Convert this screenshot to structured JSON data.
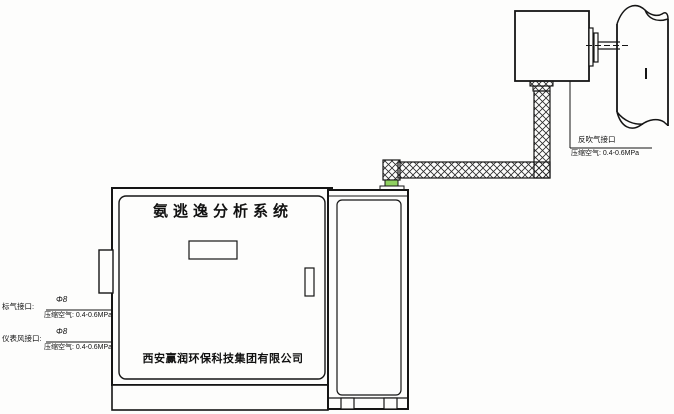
{
  "diagram": {
    "cabinet": {
      "title": "氨逃逸分析系统",
      "company": "西安赢润环保科技集团有限公司"
    },
    "annotations": {
      "probe_port": {
        "label": "反吹气接口",
        "spec": "压缩空气: 0.4-0.6MPa"
      },
      "cabinet_ports": [
        {
          "label": "标气接口:",
          "diameter": "Φ8",
          "spec": "压缩空气: 0.4-0.6MPa"
        },
        {
          "label": "仪表风接口:",
          "diameter": "Φ8",
          "spec": "压缩空气: 0.4-0.6MPa"
        }
      ]
    },
    "components": {
      "stack": "flue-stack-pipe",
      "probe": "sampling-probe-box",
      "flange": "probe-mounting-flange",
      "sample_line": "heated-sample-line",
      "cabinet": "analyzer-cabinet",
      "screen": "display-screen",
      "handle": "door-handle",
      "rack": "side-equipment-rack",
      "side_box": "cabinet-side-port-box"
    },
    "colors": {
      "line": "#151515",
      "background": "#fdfdfc",
      "fitting_accent": "#8fd060"
    }
  }
}
